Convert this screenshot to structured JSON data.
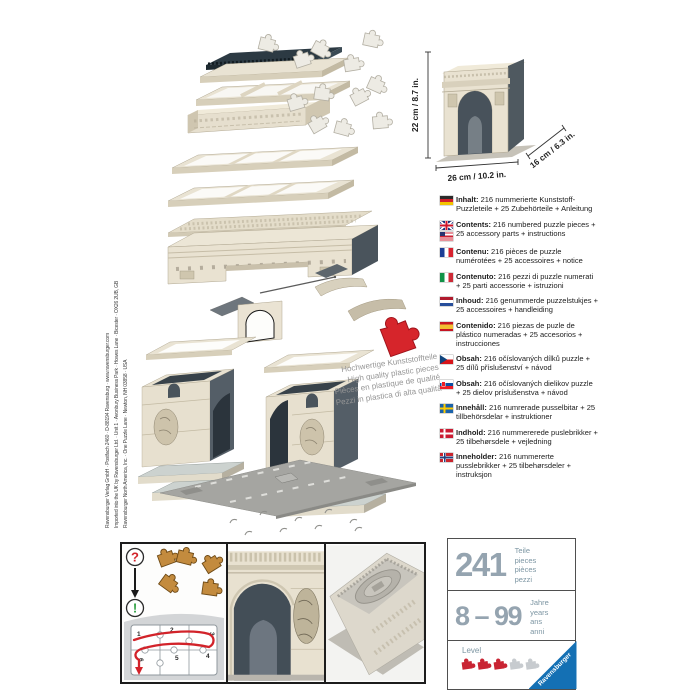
{
  "imprint": {
    "lines": [
      "Ravensburger Verlag GmbH · Postfach 2460 · D-88194 Ravensburg · www.ravensburger.com",
      "Imported into the UK by Ravensburger Ltd. · Unit 1 · Avonbury Business Park · Howes Lane · Bicester · OX26 2UB, GB",
      "Ravensburger North America, Inc. · One Puzzle Lane · Newton, NH 03858 · USA"
    ]
  },
  "size_diagram": {
    "height_label": "22 cm / 8.7 in.",
    "width_label": "26 cm / 10.2 in.",
    "depth_label": "16 cm / 6.3 in."
  },
  "quality_badge": {
    "lines": [
      "Hochwertige Kunststoffteile",
      "High quality plastic pieces",
      "Pièces en plastique de qualité",
      "Pezzi in plastica di alta qualità"
    ]
  },
  "contents": [
    {
      "lang": "german",
      "label": "Inhalt:",
      "text": "216 nummerierte Kunststoff-Puzzleteile + 25 Zubehörteile + Anleitung"
    },
    {
      "lang": "english",
      "label": "Contents:",
      "text": "216 numbered puzzle pieces + 25 accessory parts + instructions"
    },
    {
      "lang": "french",
      "label": "Contenu:",
      "text": "216 pièces de puzzle numérotées + 25 accessoires + notice"
    },
    {
      "lang": "italian",
      "label": "Contenuto:",
      "text": "216 pezzi di puzzle numerati + 25 parti accessorie + istruzioni"
    },
    {
      "lang": "dutch",
      "label": "Inhoud:",
      "text": "216 genummerde puzzelstukjes + 25 accessoires + handleiding"
    },
    {
      "lang": "spanish",
      "label": "Contenido:",
      "text": "216 piezas de puzle de plástico numeradas + 25 accesorios + instrucciones"
    },
    {
      "lang": "czech",
      "label": "Obsah:",
      "text": "216 očíslovaných dílků puzzle + 25 dílů příslušenství + návod"
    },
    {
      "lang": "slovak",
      "label": "Obsah:",
      "text": "216 očíslovaných dielikov puzzle + 25 dielov príslušenstva + návod"
    },
    {
      "lang": "swedish",
      "label": "Innehåll:",
      "text": "216 numrerade pusselbitar + 25 tillbehörsdelar + instruktioner"
    },
    {
      "lang": "danish",
      "label": "Indhold:",
      "text": "216 nummererede puslebrikker + 25 tilbehørsdele + vejledning"
    },
    {
      "lang": "norwegian",
      "label": "Inneholder:",
      "text": "216 nummererte pusslebrikker + 25 tilbehørsdeler + instruksjon"
    }
  ],
  "assembly_panel": {
    "question_mark": "?",
    "exclamation_mark": "!",
    "steps": [
      "1",
      "2",
      "3",
      "4",
      "5",
      "6"
    ]
  },
  "info_box": {
    "pieces_count": "241",
    "pieces_labels": [
      "Teile",
      "pieces",
      "pièces",
      "pezzi"
    ],
    "age_range": "8 – 99",
    "age_labels": [
      "Jahre",
      "years",
      "ans",
      "anni"
    ],
    "level_label": "Level",
    "level_filled": 3,
    "level_total": 5,
    "brand": "Ravensburger"
  },
  "icons": {
    "question_icon": "?",
    "exclamation_icon": "!",
    "level_piece_icon": "puzzle-piece",
    "red_piece_icon": "puzzle-piece",
    "flags": [
      "germany",
      "uk",
      "usa",
      "france",
      "italy",
      "netherlands",
      "spain",
      "czechia",
      "slovakia",
      "sweden",
      "denmark",
      "norway"
    ]
  },
  "colors": {
    "accent_red": "#cc2229",
    "accent_green": "#2fa042",
    "brand_blue": "#1470b4",
    "number_gray": "#95a4b0",
    "label_teal": "#7d96a3",
    "stone_cream": "#e8e2d1",
    "stone_dark": "#49545c"
  }
}
